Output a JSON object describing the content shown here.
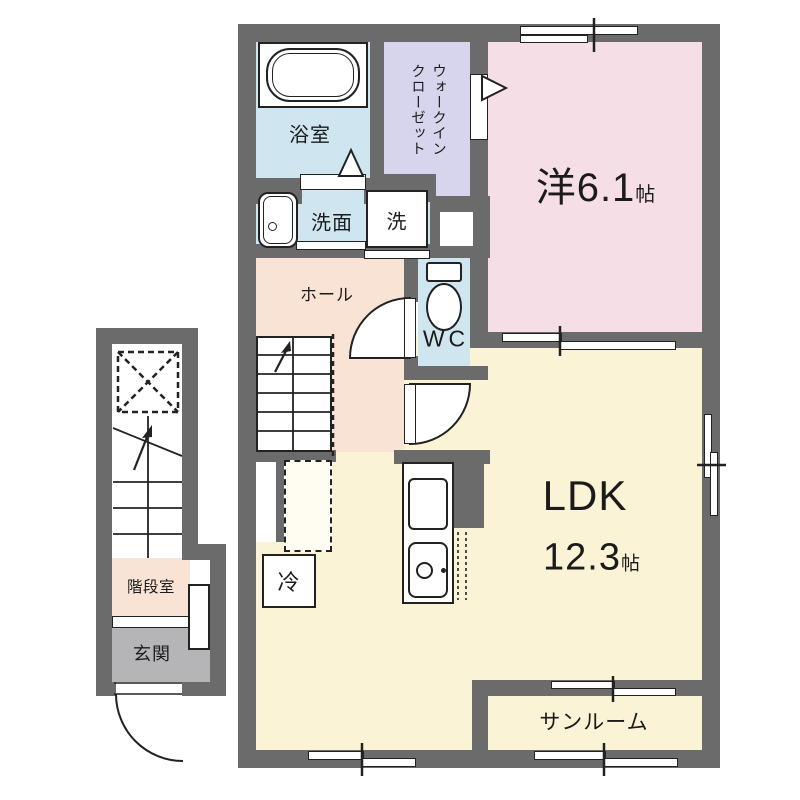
{
  "rooms": {
    "bath": {
      "label": "浴室"
    },
    "washroom": {
      "label": "洗面"
    },
    "washer": {
      "label": "洗"
    },
    "walk_in_closet": {
      "line1": "ウォークイン",
      "line2": "クローゼット"
    },
    "western_room": {
      "label": "洋6.1",
      "unit": "帖"
    },
    "hall": {
      "label": "ホール"
    },
    "wc": {
      "label": "WC"
    },
    "ldk": {
      "label": "LDK",
      "size": "12.3",
      "unit": "帖"
    },
    "refrigerator": {
      "label": "冷"
    },
    "sunroom": {
      "label": "サンルーム"
    },
    "stair_room": {
      "label": "階段室"
    },
    "entrance": {
      "label": "玄関"
    }
  },
  "colors": {
    "wall": "#6b6b6b",
    "wet_area": "#cfe6f1",
    "closet": "#d7d5ed",
    "western_room": "#f6dee7",
    "hall": "#f8e3d4",
    "ldk": "#faf3d6",
    "entrance_floor": "#b5b5b7",
    "fixture_line": "#222222"
  }
}
